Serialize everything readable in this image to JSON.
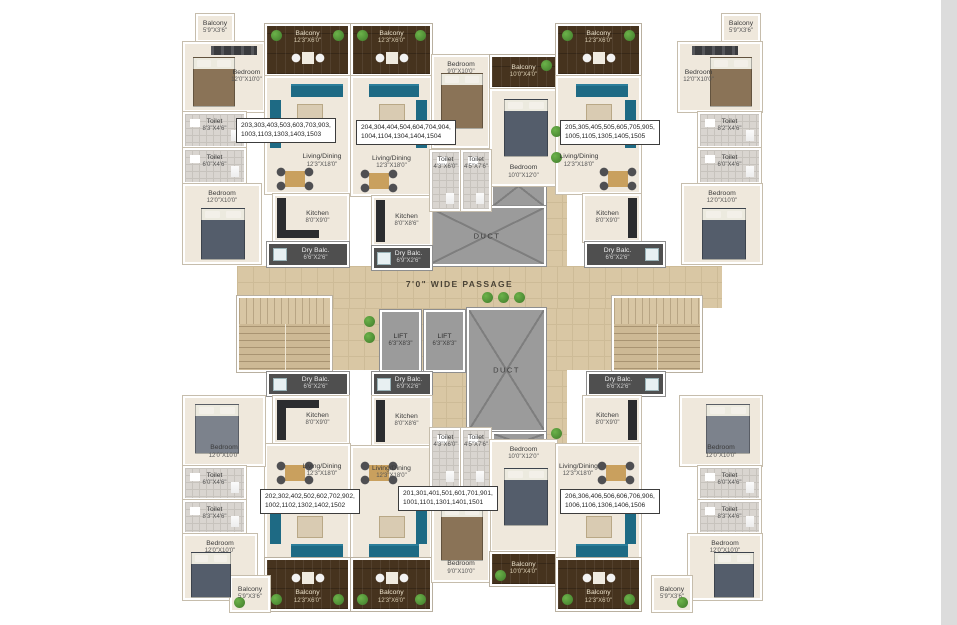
{
  "passage": {
    "label": "7'0\" WIDE PASSAGE"
  },
  "ducts": {
    "top": "DUCT",
    "bottom": "DUCT"
  },
  "lifts": {
    "left": {
      "name": "LIFT",
      "dims": "6'3\"X8'3\""
    },
    "right": {
      "name": "LIFT",
      "dims": "6'3\"X8'3\""
    }
  },
  "units": {
    "u203": {
      "line1": "203,303,403,503,603,703,903,",
      "line2": "1003,1103,1303,1403,1503"
    },
    "u204": {
      "line1": "204,304,404,504,604,704,904,",
      "line2": "1004,1104,1304,1404,1504"
    },
    "u205": {
      "line1": "205,305,405,505,605,705,905,",
      "line2": "1005,1105,1305,1405,1505"
    },
    "u202": {
      "line1": "202,302,402,502,602,702,902,",
      "line2": "1002,1102,1302,1402,1502"
    },
    "u201": {
      "line1": "201,301,401,501,601,701,901,",
      "line2": "1001,1101,1301,1401,1501"
    },
    "u206": {
      "line1": "206,306,406,506,606,706,906,",
      "line2": "1006,1106,1306,1406,1506"
    }
  },
  "rooms": {
    "tl_balcony": {
      "name": "Balcony",
      "dims": "5'9\"X3'6\""
    },
    "tl_bedroom_top": {
      "name": "Bedroom",
      "dims": "12'0\"X10'0\""
    },
    "tl_toilet_a": {
      "name": "Toilet",
      "dims": "8'3\"X4'6\""
    },
    "tl_toilet_b": {
      "name": "Toilet",
      "dims": "6'0\"X4'6\""
    },
    "tl_bedroom_bot": {
      "name": "Bedroom",
      "dims": "12'0\"X10'0\""
    },
    "u203_balcony": {
      "name": "Balcony",
      "dims": "12'3\"X6'0\""
    },
    "u203_living": {
      "name": "Living/Dining",
      "dims": "12'3\"X18'0\""
    },
    "u203_kitchen": {
      "name": "Kitchen",
      "dims": "8'0\"X9'0\""
    },
    "u203_dry": {
      "name": "Dry Balc.",
      "dims": "6'6\"X2'6\""
    },
    "u204_balcony": {
      "name": "Balcony",
      "dims": "12'3\"X6'0\""
    },
    "u204_living": {
      "name": "Living/Dining",
      "dims": "12'3\"X18'0\""
    },
    "u204_kitchen": {
      "name": "Kitchen",
      "dims": "8'0\"X8'6\""
    },
    "u204_dry": {
      "name": "Dry Balc.",
      "dims": "6'9\"X2'6\""
    },
    "tc_bedroom_l": {
      "name": "Bedroom",
      "dims": "9'0\"X10'0\""
    },
    "tc_balcony": {
      "name": "Balcony",
      "dims": "10'0\"X4'0\""
    },
    "tc_bedroom_r": {
      "name": "Bedroom",
      "dims": "10'0\"X12'0\""
    },
    "tc_toilet_a": {
      "name": "Toilet",
      "dims": "4'3\"X6'0\""
    },
    "tc_toilet_b": {
      "name": "Toilet",
      "dims": "4'5\"X7'6\""
    },
    "u205_balcony": {
      "name": "Balcony",
      "dims": "12'3\"X6'0\""
    },
    "u205_living": {
      "name": "Living/Dining",
      "dims": "12'3\"X18'0\""
    },
    "u205_kitchen": {
      "name": "Kitchen",
      "dims": "8'0\"X9'0\""
    },
    "u205_dry": {
      "name": "Dry Balc.",
      "dims": "6'6\"X2'6\""
    },
    "tr_balcony": {
      "name": "Balcony",
      "dims": "5'9\"X3'6\""
    },
    "tr_bedroom_top": {
      "name": "Bedroom",
      "dims": "12'0\"X10'0\""
    },
    "tr_toilet_a": {
      "name": "Toilet",
      "dims": "8'2\"X4'6\""
    },
    "tr_toilet_b": {
      "name": "Toilet",
      "dims": "6'0\"X4'6\""
    },
    "tr_bedroom_bot": {
      "name": "Bedroom",
      "dims": "12'0\"X10'0\""
    },
    "u202_dry": {
      "name": "Dry Balc.",
      "dims": "6'6\"X2'6\""
    },
    "u202_kitchen": {
      "name": "Kitchen",
      "dims": "8'0\"X9'0\""
    },
    "u202_living": {
      "name": "Living/Dining",
      "dims": "12'3\"X18'0\""
    },
    "u202_balcony": {
      "name": "Balcony",
      "dims": "12'3\"X6'0\""
    },
    "u201_dry": {
      "name": "Dry Balc.",
      "dims": "6'9\"X2'6\""
    },
    "u201_kitchen": {
      "name": "Kitchen",
      "dims": "8'0\"X8'6\""
    },
    "u201_living": {
      "name": "Living/Dining",
      "dims": "12'3\"X18'0\""
    },
    "u201_balcony": {
      "name": "Balcony",
      "dims": "12'3\"X6'0\""
    },
    "bc_toilet_a": {
      "name": "Toilet",
      "dims": "4'3\"X6'0\""
    },
    "bc_toilet_b": {
      "name": "Toilet",
      "dims": "4'5\"X7'6\""
    },
    "bc_bedroom_r": {
      "name": "Bedroom",
      "dims": "10'0\"X12'0\""
    },
    "bc_bedroom_l": {
      "name": "Bedroom",
      "dims": "9'0\"X10'0\""
    },
    "bc_balcony": {
      "name": "Balcony",
      "dims": "10'0\"X4'0\""
    },
    "u206_dry": {
      "name": "Dry Balc.",
      "dims": "6'6\"X2'6\""
    },
    "u206_kitchen": {
      "name": "Kitchen",
      "dims": "8'0\"X9'0\""
    },
    "u206_living": {
      "name": "Living/Dining",
      "dims": "12'3\"X18'0\""
    },
    "u206_balcony": {
      "name": "Balcony",
      "dims": "12'3\"X6'0\""
    },
    "bl_bedroom_top": {
      "name": "Bedroom",
      "dims": "12'0\"X10'0\""
    },
    "bl_toilet_a": {
      "name": "Toilet",
      "dims": "6'0\"X4'6\""
    },
    "bl_toilet_b": {
      "name": "Toilet",
      "dims": "8'3\"X4'6\""
    },
    "bl_bedroom_bot": {
      "name": "Bedroom",
      "dims": "12'0\"X10'0\""
    },
    "bl_balcony": {
      "name": "Balcony",
      "dims": "5'9\"X3'6\""
    },
    "br_bedroom_top": {
      "name": "Bedroom",
      "dims": "12'0\"X10'0\""
    },
    "br_toilet_a": {
      "name": "Toilet",
      "dims": "6'0\"X4'6\""
    },
    "br_toilet_b": {
      "name": "Toilet",
      "dims": "8'3\"X4'6\""
    },
    "br_bedroom_bot": {
      "name": "Bedroom",
      "dims": "12'0\"X10'0\""
    },
    "br_balcony": {
      "name": "Balcony",
      "dims": "5'9\"X3'6\""
    }
  },
  "colors": {
    "wood_deck": "#46331e",
    "passage_floor": "#d9c7a4",
    "duct_gray": "#9b9b9b",
    "furniture_teal": "#1e6a84",
    "plant_green": "#4e9637",
    "room_floor": "#efe8dc",
    "tile_gray": "#d9d5d0",
    "scrollbar": "#dcdcdc"
  }
}
